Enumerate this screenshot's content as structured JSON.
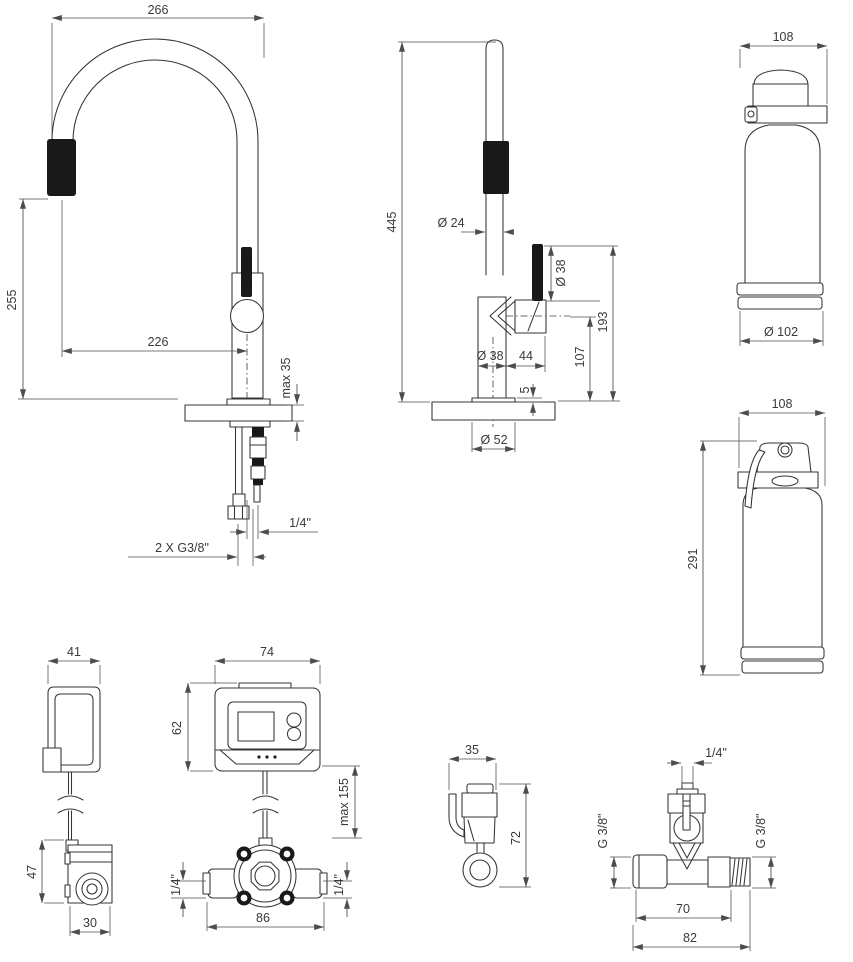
{
  "views": {
    "faucet_front": {
      "label": "faucet front view",
      "dims": {
        "spout_width": "266",
        "spray_height": "255",
        "reach": "226",
        "counter_thickness": "max 35",
        "outlet_hose": "1/4\"",
        "supply_hoses": "2 X G3/8\""
      }
    },
    "faucet_side": {
      "label": "faucet side view",
      "dims": {
        "total_height": "445",
        "spout_diameter": "Ø 24",
        "handle_diameter": "Ø 38",
        "handle_top_height": "193",
        "handle_axis_height": "107",
        "handle_offset": "44",
        "body_diameter": "Ø 38",
        "base_thickness": "5",
        "base_diameter": "Ø 52"
      }
    },
    "filter_front": {
      "label": "filter cartridge front view",
      "dims": {
        "width": "108",
        "diameter": "Ø 102"
      }
    },
    "filter_side": {
      "label": "filter cartridge side view",
      "dims": {
        "width": "108",
        "height": "291"
      }
    },
    "hook_and_head": {
      "label": "hook bracket with filter head",
      "dims": {
        "bracket_width": "41",
        "head_height": "47",
        "head_width": "30"
      }
    },
    "control_box": {
      "label": "control unit with solenoid valve block",
      "dims": {
        "width": "74",
        "height": "62",
        "cable_length": "max 155",
        "left_port": "1/4\"",
        "right_port": "1/4\"",
        "valve_width": "86"
      }
    },
    "shutoff_valve": {
      "label": "shut-off valve",
      "dims": {
        "width": "35",
        "height": "72"
      }
    },
    "tee_fitting": {
      "label": "tee fitting",
      "dims": {
        "top_port": "1/4\"",
        "left_thread": "G 3/8\"",
        "right_thread": "G 3/8\"",
        "center_width": "70",
        "total_width": "82"
      }
    }
  },
  "colors": {
    "background": "#ffffff",
    "line": "#343434",
    "dimension": "#4c4c4c",
    "text": "#3a3a3a",
    "fill_dark": "#191919"
  }
}
